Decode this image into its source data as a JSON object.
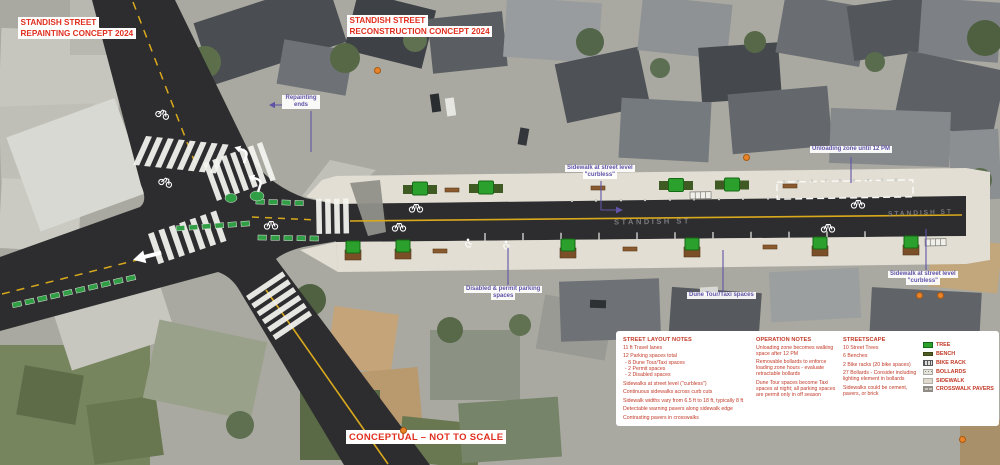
{
  "titles": {
    "repainting": [
      "STANDISH STREET",
      "REPAINTING CONCEPT 2024"
    ],
    "reconstruction": [
      "STANDISH STREET",
      "RECONSTRUCTION CONCEPT 2024"
    ]
  },
  "footer": {
    "conceptual": "CONCEPTUAL – NOT TO SCALE"
  },
  "street_label": "STANDISH ST",
  "callouts": {
    "repainting_ends": "Repainting ends",
    "sidewalk_curbless_left": [
      "Sidewalk at street level",
      "\"curbless\""
    ],
    "unloading_zone": "Unloading zone until 12 PM",
    "disabled_permit": [
      "Disabled & permit parking",
      "spaces"
    ],
    "dune_taxi": "Dune Tour/Taxi spaces",
    "sidewalk_curbless_right": [
      "Sidewalk at street level",
      "\"curbless\""
    ]
  },
  "notes": {
    "street_layout": {
      "heading": "STREET LAYOUT NOTES",
      "items": [
        "11 ft Travel lanes",
        "12 Parking spaces total",
        "- 8 Dune Tour/Taxi spaces",
        "- 2 Permit spaces",
        "- 2 Disabled spaces",
        "Sidewalks at street level (\"curbless\")",
        "Continuous sidewalks across curb cuts",
        "Sidewalk widths vary from 6.5 ft to 18 ft, typically 8 ft",
        "Detectable warning pavers along sidewalk edge",
        "Contrasting pavers in crosswalks"
      ]
    },
    "operation": {
      "heading": "OPERATION NOTES",
      "items": [
        "Unloading zone becomes walking space after 12 PM",
        "Removable bollards to enforce loading zone hours - evaluate retractable bollards",
        "Dune Tour spaces become Taxi spaces at night; all parking spaces are permit only in off season"
      ]
    },
    "streetscape": {
      "heading": "STREETSCAPE",
      "items": [
        "10 Street Trees",
        "6 Benches",
        "2 Bike racks (20 bike spaces)",
        "27 Bollards - Consider including lighting element in bollards",
        "Sidewalks could be cement, pavers, or brick"
      ]
    }
  },
  "legend": {
    "items": [
      {
        "label": "TREE",
        "swatch": "tree"
      },
      {
        "label": "BENCH",
        "swatch": "bench"
      },
      {
        "label": "BIKE RACK",
        "swatch": "bikerack"
      },
      {
        "label": "BOLLARDS",
        "swatch": "bollards"
      },
      {
        "label": "SIDEWALK",
        "swatch": "sidewalk"
      },
      {
        "label": "CROSSWALK PAVERS",
        "swatch": "crosswalk"
      }
    ]
  },
  "colors": {
    "title_red": "#e02f1f",
    "notes_red": "#c23a28",
    "callout_purple": "#5f53a6",
    "tree_green": "#2ca02c",
    "asphalt": "#2d2d2f",
    "sidewalk_beige": "#e2ded4",
    "centerline_yellow": "#d9a91c"
  }
}
